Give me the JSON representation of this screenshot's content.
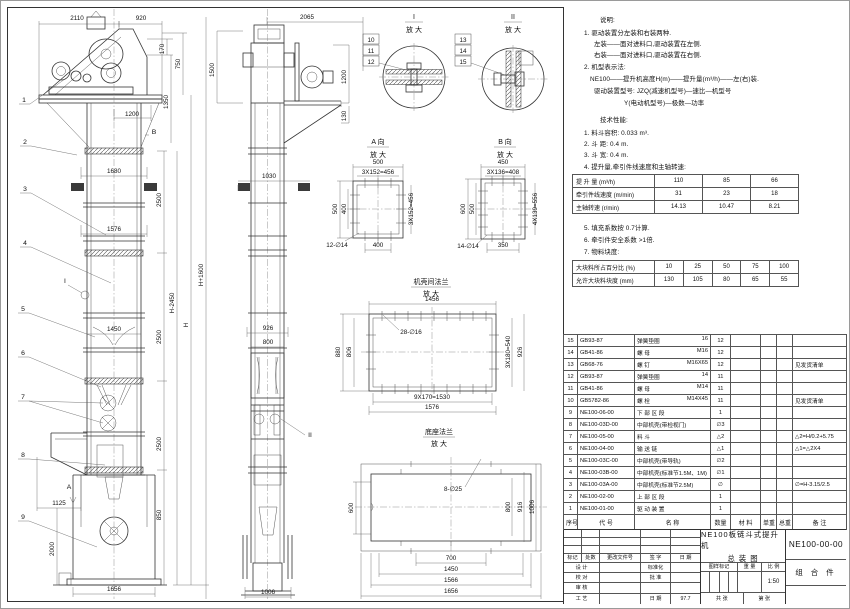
{
  "notes": {
    "heading": "说明:",
    "lines": [
      "1. 驱动装置分左装和右装两种.",
      "左装——面对进料口,驱动装置在左侧.",
      "右装——面对进料口,驱动装置在右侧.",
      "2. 机型表示法:",
      "NE100——提升机高度H(m)——提升量(m³/h)——左(右)装.",
      "驱动装置型号: JZQ(减速机型号)—速比—机型号",
      "Y(电动机型号)—极数—功率"
    ]
  },
  "tech": {
    "heading": "技术性能:",
    "items": [
      "1. 料斗容积: 0.033 m³.",
      "2. 斗  距: 0.4 m.",
      "3. 斗  宽: 0.4 m.",
      "4. 提升量,牵引件线速度和主轴转速:",
      "5. 填充系数按 0.7计算.",
      "6. 牵引件安全系数 >1倍.",
      "7. 物料块度:"
    ],
    "speed_table": {
      "rows": [
        [
          "提 升 量 (m³/h)",
          "110",
          "85",
          "66"
        ],
        [
          "牵引件线速度 (m/min)",
          "31",
          "23",
          "18"
        ],
        [
          "主轴转速 (r/min)",
          "14.13",
          "10.47",
          "8.21"
        ]
      ]
    },
    "lump_table": {
      "rows": [
        [
          "大块料所占百分比 (%)",
          "10",
          "25",
          "50",
          "75",
          "100"
        ],
        [
          "允许大块料块度 (mm)",
          "130",
          "105",
          "80",
          "65",
          "55"
        ]
      ]
    }
  },
  "bom": {
    "headers": [
      "序号",
      "代  号",
      "名  称",
      "数量",
      "材 料",
      "单重",
      "总重",
      "备 注"
    ],
    "rows": [
      {
        "no": "15",
        "code": "GB93-87",
        "name": "弹簧垫圈",
        "spec": "16",
        "qty": "12",
        "remark": ""
      },
      {
        "no": "14",
        "code": "GB41-86",
        "name": "螺 母",
        "spec": "M16",
        "qty": "12",
        "remark": ""
      },
      {
        "no": "13",
        "code": "GB68-76",
        "name": "螺 钉",
        "spec": "M16X65",
        "qty": "12",
        "remark": "见发货清单"
      },
      {
        "no": "12",
        "code": "GB93-87",
        "name": "弹簧垫圈",
        "spec": "14",
        "qty": "11",
        "remark": ""
      },
      {
        "no": "11",
        "code": "GB41-86",
        "name": "螺 母",
        "spec": "M14",
        "qty": "11",
        "remark": ""
      },
      {
        "no": "10",
        "code": "GB5782-86",
        "name": "螺 栓",
        "spec": "M14X45",
        "qty": "11",
        "remark": "见发货清单"
      },
      {
        "no": "9",
        "code": "NE100-06-00",
        "name": "下 部 区 段",
        "spec": "",
        "qty": "1",
        "remark": ""
      },
      {
        "no": "8",
        "code": "NE100-03D-00",
        "name": "中部机壳(带检视门)",
        "spec": "",
        "qty": "∅3",
        "remark": ""
      },
      {
        "no": "7",
        "code": "NE100-05-00",
        "name": "料 斗",
        "spec": "",
        "qty": "△2",
        "remark": "△2=H/0.2+5.75"
      },
      {
        "no": "6",
        "code": "NE100-04-00",
        "name": "输 送 链",
        "spec": "",
        "qty": "△1",
        "remark": "△1=△2X4"
      },
      {
        "no": "5",
        "code": "NE100-03C-00",
        "name": "中部机壳(带导轨)",
        "spec": "",
        "qty": "∅2",
        "remark": ""
      },
      {
        "no": "4",
        "code": "NE100-03B-00",
        "name": "中部机壳(标准节1.5M、1M)",
        "spec": "",
        "qty": "∅1",
        "remark": ""
      },
      {
        "no": "3",
        "code": "NE100-03A-00",
        "name": "中部机壳(标准节2.5M)",
        "spec": "",
        "qty": "∅",
        "remark": "∅=H-3.15/2.5"
      },
      {
        "no": "2",
        "code": "NE100-02-00",
        "name": "上 部 区 段",
        "spec": "",
        "qty": "1",
        "remark": ""
      },
      {
        "no": "1",
        "code": "NE100-01-00",
        "name": "驱 动 装 置",
        "spec": "",
        "qty": "1",
        "remark": ""
      }
    ]
  },
  "title_block": {
    "title_line1": "NE100板链斗式提升机",
    "title_line2": "总  装  图",
    "drawing_no": "NE100-00-00",
    "part_type": "组 合 件",
    "rev_headers": [
      "标记",
      "处数",
      "更改文件号",
      "签 字",
      "日 期"
    ],
    "role1": "设 计",
    "role1b": "标准化",
    "role2": "校 对",
    "role2b": "批 准",
    "role3": "审 核",
    "role4": "工 艺",
    "role4b": "日 期",
    "date": "97.7",
    "stamp_headers": [
      "图样标记",
      "重 量",
      "比 例"
    ],
    "scale": "1:50",
    "sheet_l": "共  张",
    "sheet_r": "第  张"
  },
  "drawing": {
    "front": {
      "w2110": "2110",
      "w920": "920",
      "h170": "170",
      "h750": "750",
      "h1350": "1350",
      "w1200": "1200",
      "w1680": "1680",
      "h2500a": "2500",
      "w1576": "1576",
      "hH2450": "H-2450",
      "hH": "H",
      "hH1600": "H+1600",
      "w1450": "1450",
      "h2500b": "2500",
      "h2500c": "2500",
      "h2500d": "2500",
      "w1125": "1125",
      "h2000": "2000",
      "h850": "850",
      "w1656": "1656",
      "viewA": "A",
      "viewB": "B",
      "detailI": "I"
    },
    "side": {
      "w2065": "2065",
      "h1500": "1500",
      "h1200": "1200",
      "h130": "130",
      "w1030": "1030",
      "w926": "926",
      "w800": "800",
      "w1006": "1006",
      "detailII": "II"
    },
    "d1": {
      "title": "I",
      "sub": "放 大",
      "b10": "10",
      "b11": "11",
      "b12": "12"
    },
    "d2": {
      "title": "II",
      "sub": "放 大",
      "b13": "13",
      "b14": "14",
      "b15": "15"
    },
    "va": {
      "title": "A 向",
      "sub": "放 大",
      "t500": "500",
      "s456": "3X152=456",
      "l500": "500",
      "l400": "400",
      "r456": "3X152=456",
      "b400": "400",
      "holes": "12-∅14"
    },
    "vb": {
      "title": "B 向",
      "sub": "放 大",
      "t450": "450",
      "s408": "3X136=408",
      "l600": "600",
      "l500": "500",
      "r556": "4X139=556",
      "b350": "350",
      "holes": "14-∅14"
    },
    "f1": {
      "title": "机壳间法兰",
      "sub": "放 大",
      "t1456": "1456",
      "l880": "880",
      "l806": "806",
      "holes": "28-∅16",
      "r540": "3X180=540",
      "r926": "926",
      "b1530": "9X170=1530",
      "b1576": "1576"
    },
    "f2": {
      "title": "底座法兰",
      "sub": "放 大",
      "l600": "600",
      "holes": "8-∅25",
      "r800": "800",
      "r916": "916",
      "r1006": "1006",
      "b700": "700",
      "b1450": "1450",
      "b1566": "1566",
      "b1656": "1656"
    },
    "balloons": {
      "b1": "1",
      "b2": "2",
      "b3": "3",
      "b4": "4",
      "b5": "5",
      "b6": "6",
      "b7": "7",
      "b8": "8",
      "b9": "9"
    }
  }
}
